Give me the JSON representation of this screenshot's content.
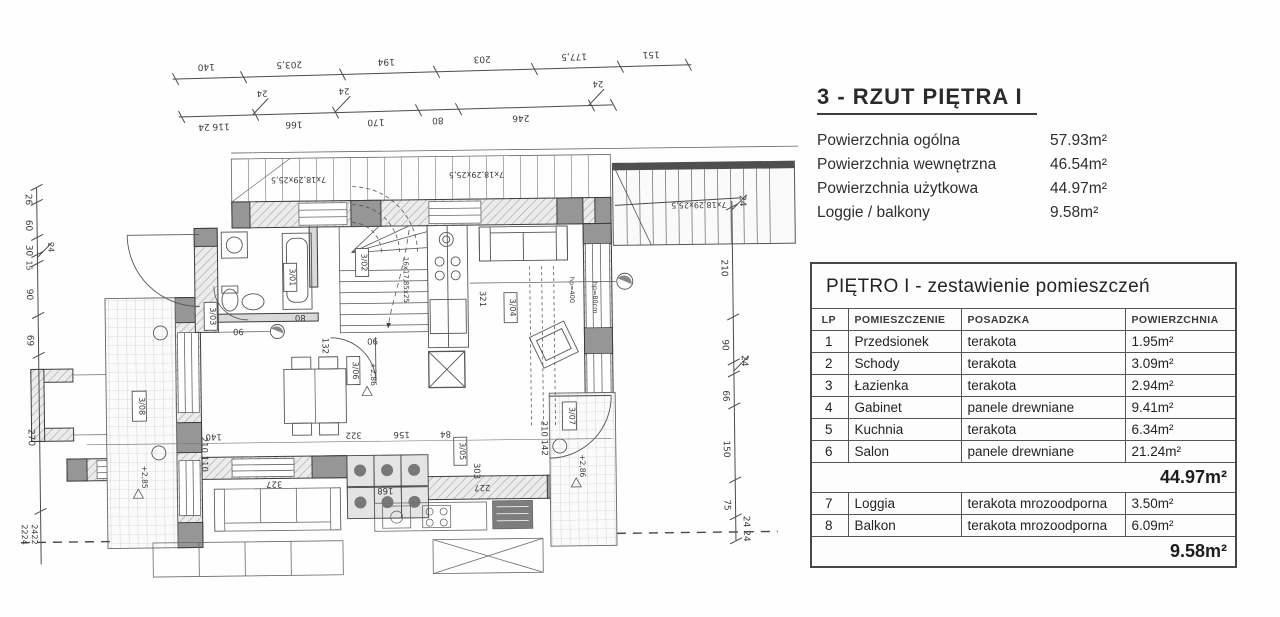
{
  "info": {
    "title": "3 - RZUT PIĘTRA I",
    "areas": [
      {
        "label": "Powierzchnia ogólna",
        "value": "57.93m²"
      },
      {
        "label": "Powierzchnia wewnętrzna",
        "value": "46.54m²"
      },
      {
        "label": "Powierzchnia użytkowa",
        "value": "44.97m²"
      },
      {
        "label": "Loggie / balkony",
        "value": "9.58m²"
      }
    ]
  },
  "table": {
    "title": "PIĘTRO I - zestawienie pomieszczeń",
    "columns": [
      "LP",
      "POMIESZCZENIE",
      "POSADZKA",
      "POWIERZCHNIA"
    ],
    "rows": [
      {
        "lp": "1",
        "name": "Przedsionek",
        "floor": "terakota",
        "area": "1.95m²"
      },
      {
        "lp": "2",
        "name": "Schody",
        "floor": "terakota",
        "area": "3.09m²"
      },
      {
        "lp": "3",
        "name": "Łazienka",
        "floor": "terakota",
        "area": "2.94m²"
      },
      {
        "lp": "4",
        "name": "Gabinet",
        "floor": "panele drewniane",
        "area": "9.41m²"
      },
      {
        "lp": "5",
        "name": "Kuchnia",
        "floor": "terakota",
        "area": "6.34m²"
      },
      {
        "lp": "6",
        "name": "Salon",
        "floor": "panele drewniane",
        "area": "21.24m²"
      }
    ],
    "subtotal_main": "44.97m²",
    "rows2": [
      {
        "lp": "7",
        "name": "Loggia",
        "floor": "terakota mrozoodporna",
        "area": "3.50m²"
      },
      {
        "lp": "8",
        "name": "Balkon",
        "floor": "terakota mrozoodporna",
        "area": "6.09m²"
      }
    ],
    "subtotal_balcony": "9.58m²"
  },
  "plan": {
    "dim_top_row1": [
      "140",
      "203,5",
      "194",
      "203",
      "177,5",
      "151"
    ],
    "dim_top_row2": [
      "116 24",
      "166",
      "170",
      "80",
      "246"
    ],
    "flag": "24",
    "dim_right": [
      "210",
      "90",
      "66",
      "150",
      "75"
    ],
    "dim_right_flag_top": "24",
    "dim_right_flag_mid": "24",
    "dim_right_flag_bottom": "24 24",
    "dim_left": [
      "26",
      "60",
      "30",
      "15",
      "90",
      "69",
      "270"
    ],
    "dim_left_bottom_a": "2224",
    "dim_left_bottom_b": "2422",
    "stair_note_balcony": "7x18,29x25,5",
    "stair_note_main": "16x17,85x25",
    "room_tags": [
      "3/01",
      "3/02",
      "3/03",
      "3/04",
      "3/05",
      "3/06",
      "3/07",
      "3/08"
    ],
    "levels": {
      "main": "+2,86",
      "left_loggia": "+2,85",
      "right_loggia": "+2,86"
    },
    "inner_dims": {
      "hall": "132",
      "salon": "321",
      "d322": "322",
      "d156": "156",
      "d84": "84",
      "d303": "303",
      "d227": "227",
      "d168": "168",
      "d327": "327",
      "d140": "140",
      "door_left": "210 110",
      "door_loggia": "210 142",
      "d90": "90",
      "d80": "80",
      "hp1": "hp=400",
      "hp2": "hp=80cm"
    }
  }
}
